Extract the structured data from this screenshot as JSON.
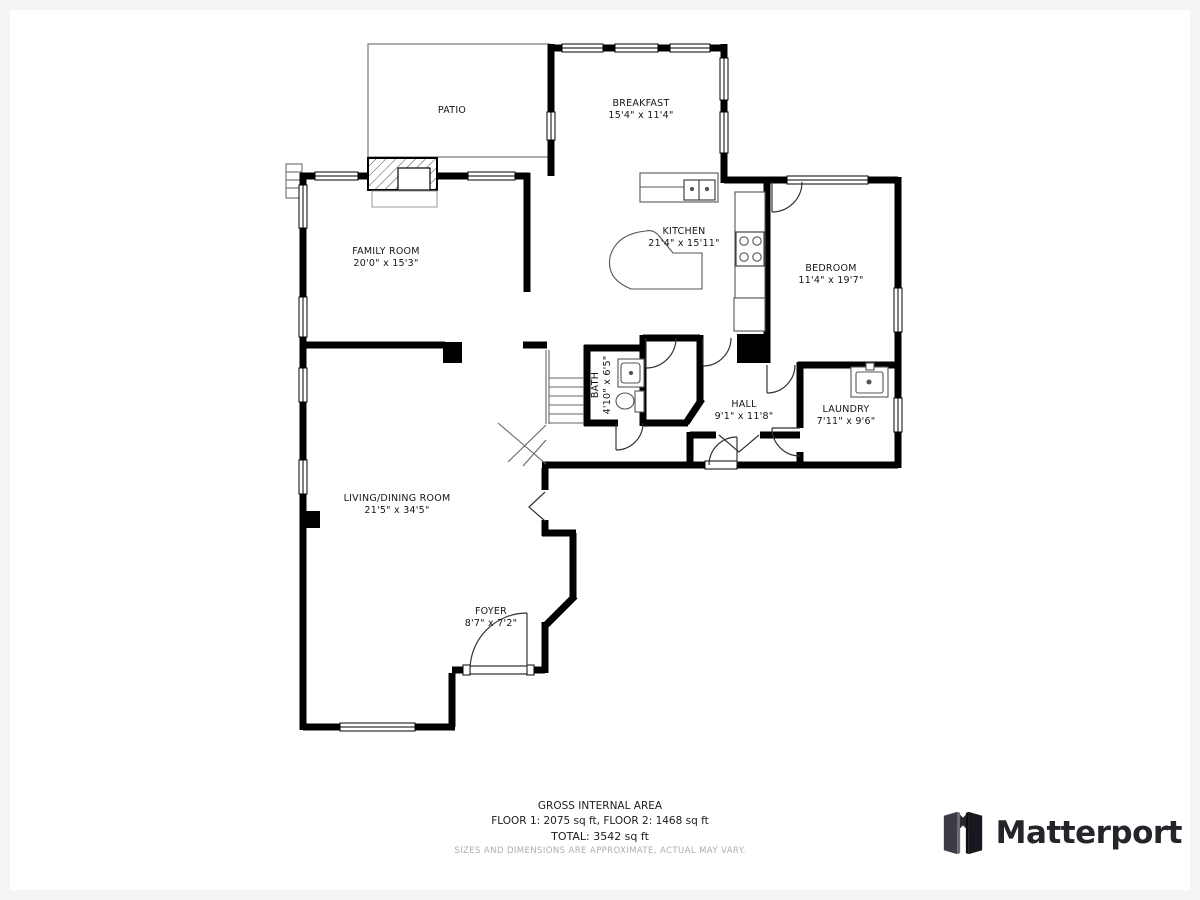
{
  "plan": {
    "rooms": [
      {
        "name": "PATIO",
        "dims": ""
      },
      {
        "name": "BREAKFAST",
        "dims": "15'4\" x 11'4\""
      },
      {
        "name": "FAMILY ROOM",
        "dims": "20'0\" x 15'3\""
      },
      {
        "name": "KITCHEN",
        "dims": "21'4\" x 15'11\""
      },
      {
        "name": "BEDROOM",
        "dims": "11'4\" x 19'7\""
      },
      {
        "name": "BATH",
        "dims": "4'10\" x 6'5\""
      },
      {
        "name": "HALL",
        "dims": "9'1\" x 11'8\""
      },
      {
        "name": "LAUNDRY",
        "dims": "7'11\" x 9'6\""
      },
      {
        "name": "LIVING/DINING ROOM",
        "dims": "21'5\" x 34'5\""
      },
      {
        "name": "FOYER",
        "dims": "8'7\" x 7'2\""
      }
    ]
  },
  "footer": {
    "title": "GROSS INTERNAL AREA",
    "floors": "FLOOR 1: 2075 sq ft, FLOOR 2: 1468 sq ft",
    "total": "TOTAL: 3542 sq ft",
    "disclaimer": "SIZES AND DIMENSIONS ARE APPROXIMATE, ACTUAL MAY VARY."
  },
  "brand": {
    "name": "Matterport"
  }
}
